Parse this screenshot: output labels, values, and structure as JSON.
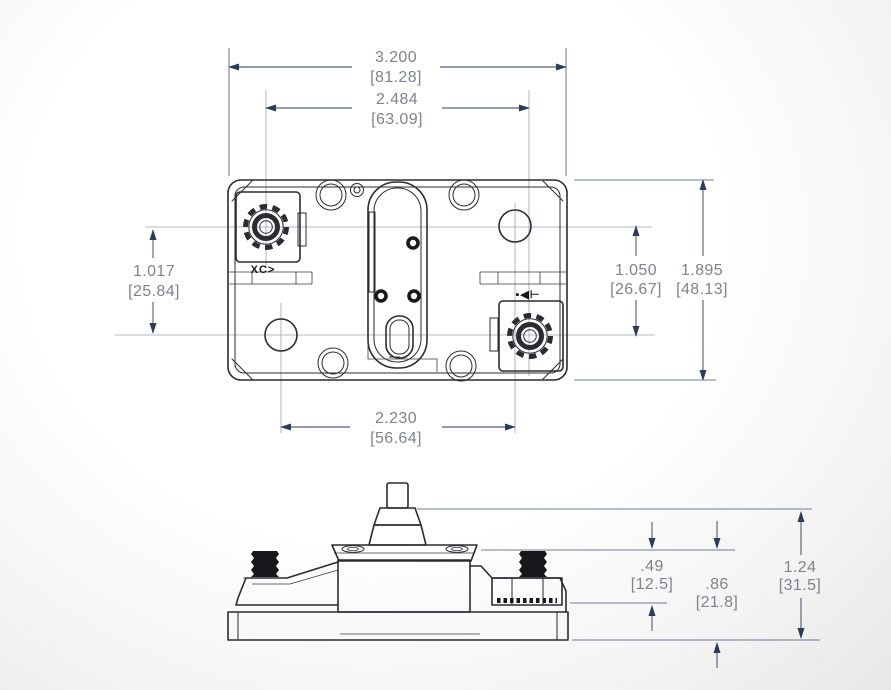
{
  "drawing": {
    "colors": {
      "line": "#2b2b31",
      "dimension": "#2c3a5c",
      "dim_text": "#7e838c"
    },
    "top_view": {
      "dim_overall_width": {
        "inches": "3.200",
        "mm": "[81.28]"
      },
      "dim_stud_spacing": {
        "inches": "2.484",
        "mm": "[63.09]"
      },
      "dim_left_height": {
        "inches": "1.017",
        "mm": "[25.84]"
      },
      "dim_right_height": {
        "inches": "1.050",
        "mm": "[26.67]"
      },
      "dim_overall_height": {
        "inches": "1.895",
        "mm": "[48.13]"
      },
      "dim_hole_spacing": {
        "inches": "2.230",
        "mm": "[56.64]"
      },
      "marking_left_terminal": "XC>",
      "marking_right_terminal": "▪◀⊢"
    },
    "side_view": {
      "dim_flange_height": {
        "inches": ".49",
        "mm": "[12.5]"
      },
      "dim_body_height": {
        "inches": ".86",
        "mm": "[21.8]"
      },
      "dim_overall_height": {
        "inches": "1.24",
        "mm": "[31.5]"
      }
    }
  }
}
